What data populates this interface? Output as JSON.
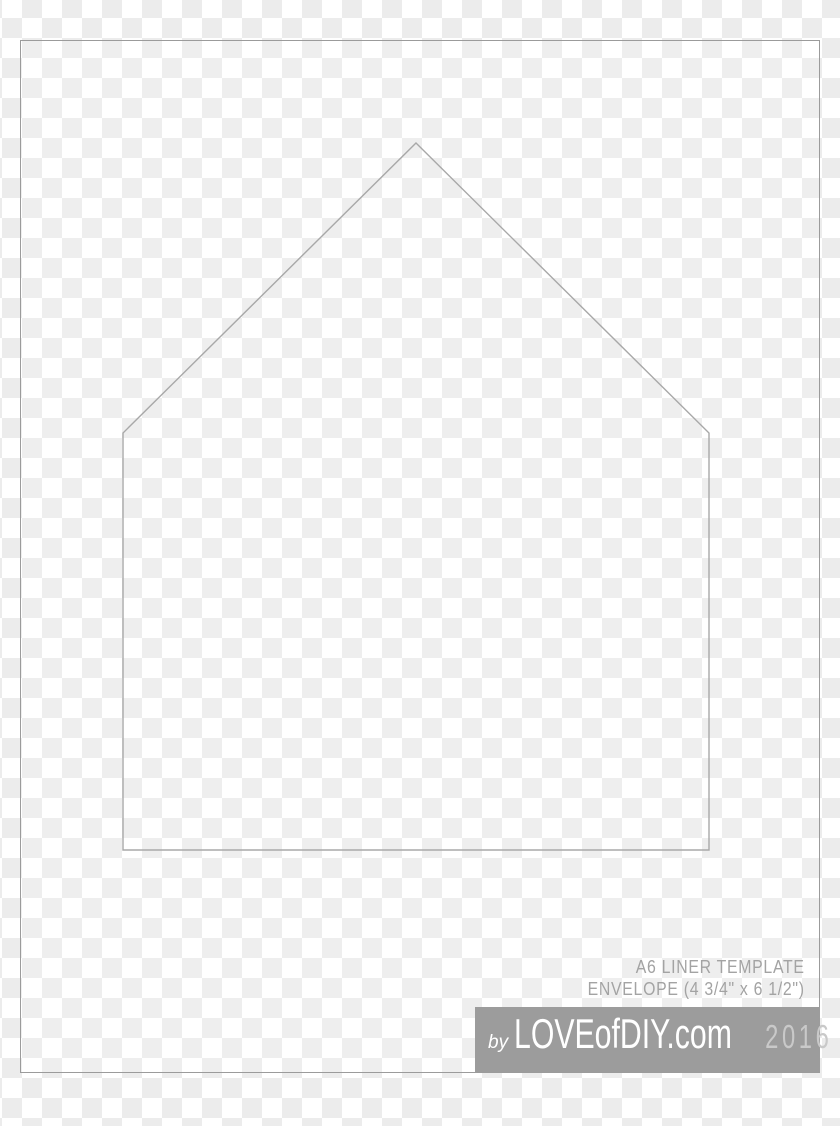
{
  "caption": {
    "title": "A6 LINER TEMPLATE",
    "size_line": "ENVELOPE (4 3/4\" x 6 1/2\")"
  },
  "banner": {
    "by_label": "by",
    "brand": "LOVEofDIY.com",
    "year": "2016",
    "bg_color": "#9c9c9c",
    "brand_color": "#ffffff",
    "year_color": "#c9c9c9"
  },
  "liner": {
    "shape": "envelope-liner-pentagon",
    "points": "416,143 709,433 709,850 123,850 123,433",
    "stroke_color": "#a8a8a8"
  },
  "page_frame": {
    "border_color": "#9b9b9b"
  },
  "background": {
    "checker_light": "#ffffff",
    "checker_dark": "#ececec"
  }
}
